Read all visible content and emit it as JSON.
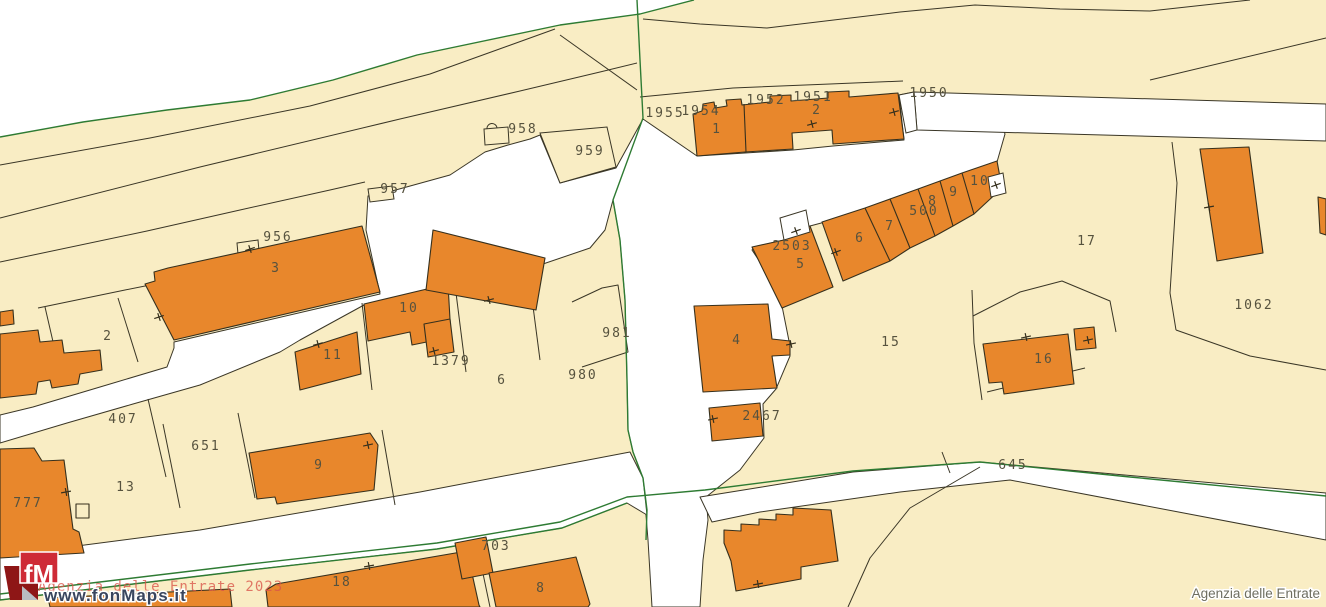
{
  "credit": "Agenzia delle Entrate",
  "logo": {
    "text": "fM",
    "url": "www.fonMaps.it"
  },
  "watermark": {
    "red_text": "Agenzia delle Entrate 2023"
  },
  "colors": {
    "parcel_fill": "#f9edc4",
    "building_fill": "#e8872c",
    "outline": "#3a3626",
    "boundary_green": "#2e7b33",
    "road_white": "#ffffff",
    "label_color": "#56523e",
    "logo_red": "#ce2b37",
    "logo_dark_red": "#8e1616",
    "watermark_red": "#d9554a"
  },
  "map": {
    "labels": [
      {
        "t": "1955",
        "x": 665,
        "y": 117
      },
      {
        "t": "1954",
        "x": 701,
        "y": 115
      },
      {
        "t": "1952",
        "x": 766,
        "y": 104
      },
      {
        "t": "1951",
        "x": 813,
        "y": 101
      },
      {
        "t": "1950",
        "x": 929,
        "y": 97
      },
      {
        "t": "1",
        "x": 717,
        "y": 133
      },
      {
        "t": "2",
        "x": 817,
        "y": 114
      },
      {
        "t": "956",
        "x": 278,
        "y": 241
      },
      {
        "t": "957",
        "x": 395,
        "y": 193
      },
      {
        "t": "958",
        "x": 523,
        "y": 133
      },
      {
        "t": "959",
        "x": 590,
        "y": 155
      },
      {
        "t": "2",
        "x": 108,
        "y": 340
      },
      {
        "t": "3",
        "x": 276,
        "y": 272
      },
      {
        "t": "10",
        "x": 409,
        "y": 312
      },
      {
        "t": "11",
        "x": 333,
        "y": 359
      },
      {
        "t": "1379",
        "x": 451,
        "y": 365
      },
      {
        "t": "6",
        "x": 502,
        "y": 384
      },
      {
        "t": "980",
        "x": 583,
        "y": 379
      },
      {
        "t": "981",
        "x": 617,
        "y": 337
      },
      {
        "t": "407",
        "x": 123,
        "y": 423
      },
      {
        "t": "651",
        "x": 206,
        "y": 450
      },
      {
        "t": "13",
        "x": 126,
        "y": 491
      },
      {
        "t": "777",
        "x": 28,
        "y": 507
      },
      {
        "t": "9",
        "x": 319,
        "y": 469
      },
      {
        "t": "2503",
        "x": 792,
        "y": 250
      },
      {
        "t": "5",
        "x": 801,
        "y": 268
      },
      {
        "t": "6",
        "x": 860,
        "y": 242
      },
      {
        "t": "7",
        "x": 890,
        "y": 230
      },
      {
        "t": "500",
        "x": 924,
        "y": 215
      },
      {
        "t": "8",
        "x": 933,
        "y": 205
      },
      {
        "t": "9",
        "x": 954,
        "y": 196
      },
      {
        "t": "10",
        "x": 980,
        "y": 185
      },
      {
        "t": "17",
        "x": 1087,
        "y": 245
      },
      {
        "t": "1062",
        "x": 1254,
        "y": 309
      },
      {
        "t": "15",
        "x": 891,
        "y": 346
      },
      {
        "t": "16",
        "x": 1044,
        "y": 363
      },
      {
        "t": "4",
        "x": 737,
        "y": 344
      },
      {
        "t": "2467",
        "x": 762,
        "y": 420
      },
      {
        "t": "645",
        "x": 1013,
        "y": 469
      },
      {
        "t": "18",
        "x": 342,
        "y": 586
      },
      {
        "t": "703",
        "x": 496,
        "y": 550
      },
      {
        "t": "8",
        "x": 541,
        "y": 592
      }
    ],
    "ticks": [
      [
        812,
        124,
        -15
      ],
      [
        894,
        112,
        -15
      ],
      [
        250,
        249,
        -18
      ],
      [
        159,
        317,
        -18
      ],
      [
        489,
        300,
        -15
      ],
      [
        434,
        351,
        -15
      ],
      [
        318,
        344,
        -15
      ],
      [
        66,
        492,
        -10
      ],
      [
        368,
        445,
        -12
      ],
      [
        369,
        566,
        -10
      ],
      [
        758,
        584,
        -10
      ],
      [
        796,
        231,
        -20
      ],
      [
        836,
        252,
        -20
      ],
      [
        996,
        185,
        -20
      ],
      [
        1209,
        207,
        -10
      ],
      [
        1026,
        337,
        -12
      ],
      [
        1088,
        340,
        -12
      ],
      [
        791,
        344,
        -12
      ],
      [
        713,
        419,
        -12
      ]
    ]
  }
}
